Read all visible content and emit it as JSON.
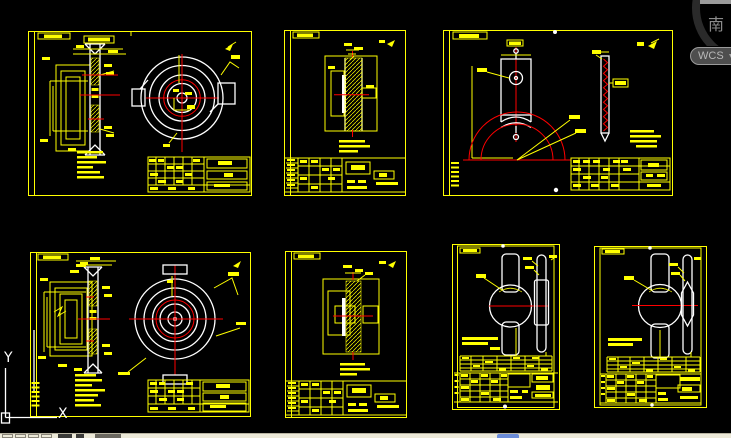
{
  "viewcube": {
    "face_label": "南",
    "wcs_label": "WCS",
    "dropdown_glyph": "▼"
  },
  "ucs_icon": {
    "x_label": "X",
    "y_label": "Y"
  },
  "colors": {
    "background": "#000000",
    "sheet_border": "#ffff00",
    "annotation_yellow": "#ffff00",
    "geometry_white": "#ffffff",
    "centerline_red": "#ff0000",
    "taskbar": "#ece9d8",
    "viewcube_ring": "#2a2a2a",
    "viewcube_text": "#8b8b8b",
    "wcs_button_bg": "#4e4e4e",
    "wcs_button_border": "#9b9b9b",
    "wcs_button_text": "#b8b8b8"
  }
}
